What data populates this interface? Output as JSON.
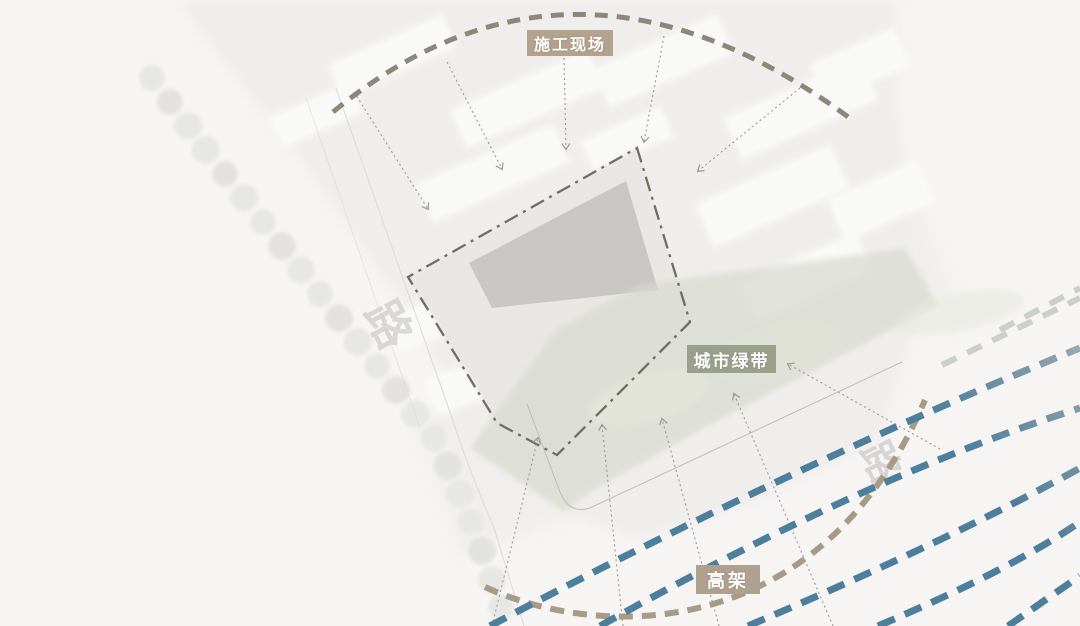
{
  "canvas": {
    "background": "#f6f5f4"
  },
  "annotations": {
    "construction_site": {
      "label": "施工现场"
    },
    "green_belt": {
      "label": "城市绿带"
    },
    "viaduct": {
      "label": "高架"
    }
  },
  "basemap": {
    "road_label_left": "路",
    "road_label_right": "路"
  },
  "styles": {
    "page_bg": "#f6f5f4",
    "badge_tan": "#b3a28d",
    "badge_green": "#99a18c",
    "badge_tan2": "#afa190",
    "top_arc": "#8d8779",
    "bottom_arc": "#a79a86",
    "viaduct_blue": "#4d7e9b",
    "viaduct_faded": "#cbcfcc",
    "boundary": "#6e6e62",
    "pointer": "#9b9a92",
    "building": "#c8c7c5",
    "green_belt_fill": "#d8dacf"
  }
}
